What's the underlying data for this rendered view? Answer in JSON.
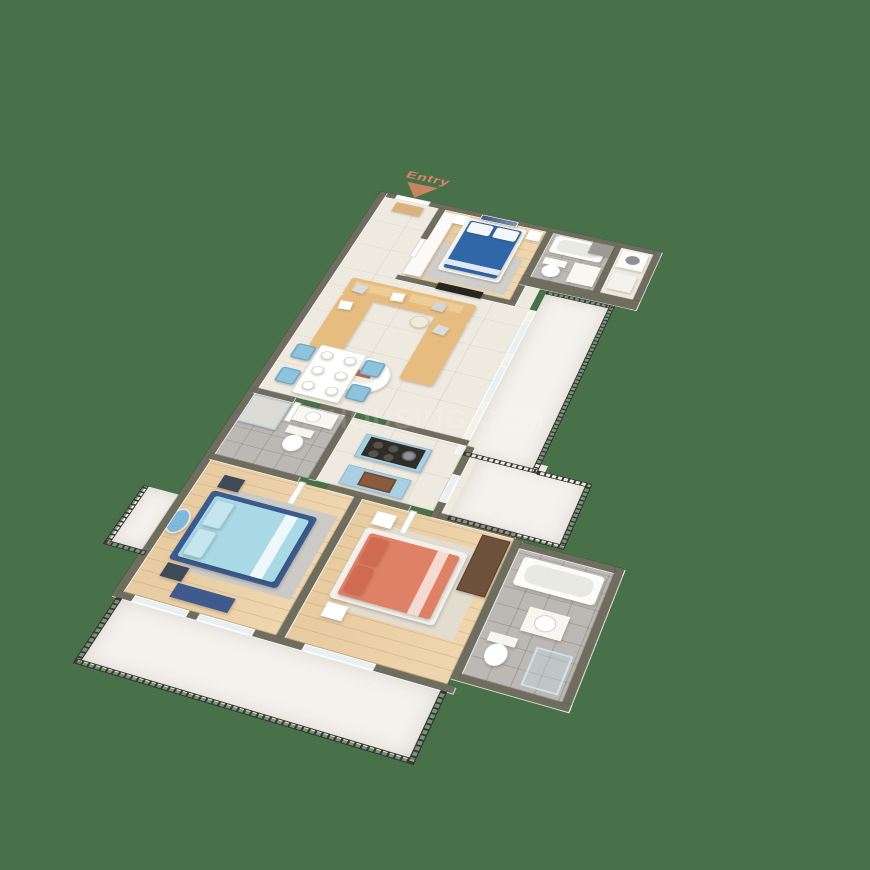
{
  "scene": {
    "description": "3D isometric floor plan render of an apartment",
    "background_color": "#48714a",
    "entry": {
      "label": "Entry",
      "arrow_color": "#e08565"
    },
    "watermark": {
      "text": "HOUSING.COM"
    }
  },
  "palette": {
    "wall_top": "#6f6d5e",
    "wall_face": "#f7f4ee",
    "wood_floor": "#ead0a8",
    "living_tile_floor": "#efeae0",
    "bathroom_tile_floor": "#bcb9b4",
    "balcony_marble_floor": "#f4f2ec",
    "railing": "#3a3934",
    "master_bed_blue": "#2f67a8",
    "bedroom2_bed_light_blue": "#a9d9e5",
    "bedroom2_frame_navy": "#3a5b8e",
    "bedroom3_bed_coral": "#df8166",
    "sofa_tan": "#e6bc80",
    "dining_chair_blue": "#8fc3dc",
    "kitchen_cabinet_blue": "#a9cfe2",
    "wardrobe_brown": "#6e513c",
    "tv_dark": "#26251f"
  },
  "rooms": [
    {
      "name": "master-bedroom",
      "floor": "wood",
      "furniture": [
        "blue-double-bed",
        "wardrobe",
        "nightstands",
        "wall-art",
        "tv-panel",
        "rug"
      ]
    },
    {
      "name": "bathroom-1",
      "floor": "tile",
      "furniture": [
        "bathtub",
        "toilet",
        "vanity"
      ]
    },
    {
      "name": "utility",
      "floor": "tile",
      "furniture": [
        "washing-machine",
        "washbasin"
      ]
    },
    {
      "name": "living-dining",
      "floor": "tile",
      "furniture": [
        "u-shaped-sofa",
        "coffee-table",
        "dining-table",
        "four-blue-chairs"
      ]
    },
    {
      "name": "kitchen",
      "floor": "tile",
      "furniture": [
        "island-with-cooktop",
        "sink-cabinet"
      ]
    },
    {
      "name": "bathroom-2",
      "floor": "tile",
      "furniture": [
        "shower",
        "toilet",
        "vanity"
      ]
    },
    {
      "name": "bedroom-2",
      "floor": "wood",
      "furniture": [
        "light-blue-bed",
        "mirror-dresser",
        "bench",
        "nightstands",
        "rug"
      ]
    },
    {
      "name": "bedroom-3",
      "floor": "wood",
      "furniture": [
        "coral-bed",
        "wardrobe",
        "nightstands",
        "rug"
      ]
    },
    {
      "name": "bathroom-3",
      "floor": "tile",
      "furniture": [
        "bathtub",
        "washbasin",
        "toilet",
        "shower"
      ]
    },
    {
      "name": "balconies",
      "floor": "marble",
      "furniture": [
        "dark-metal-railings"
      ]
    }
  ]
}
